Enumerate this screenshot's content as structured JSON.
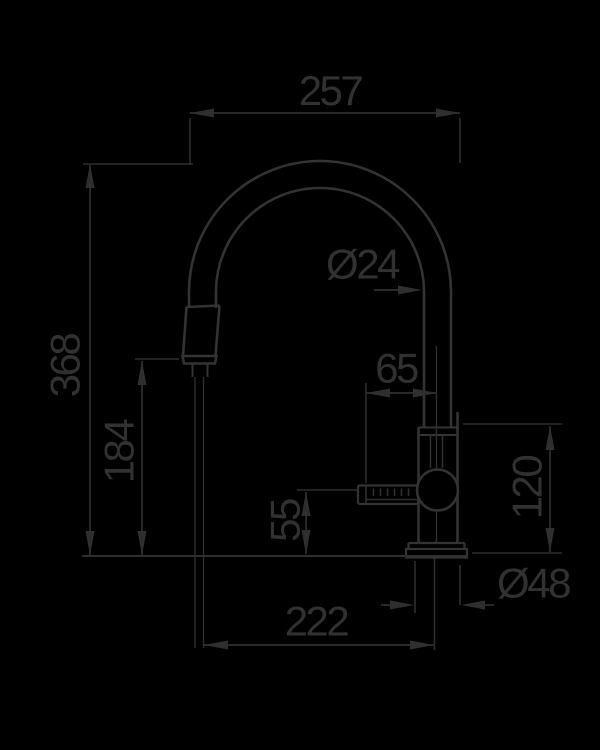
{
  "drawing": {
    "type": "technical-dimension-diagram",
    "subject": "pull-down kitchen faucet, side elevation",
    "colors": {
      "background": "#000000",
      "ink": "#313131"
    },
    "labels": {
      "top_width": "257",
      "overall_height": "368",
      "outlet_height": "184",
      "spout_diameter": "Ø24",
      "lever_length": "65",
      "lever_height": "55",
      "upper_body_height": "120",
      "base_diameter": "Ø48",
      "spout_reach": "222"
    }
  }
}
